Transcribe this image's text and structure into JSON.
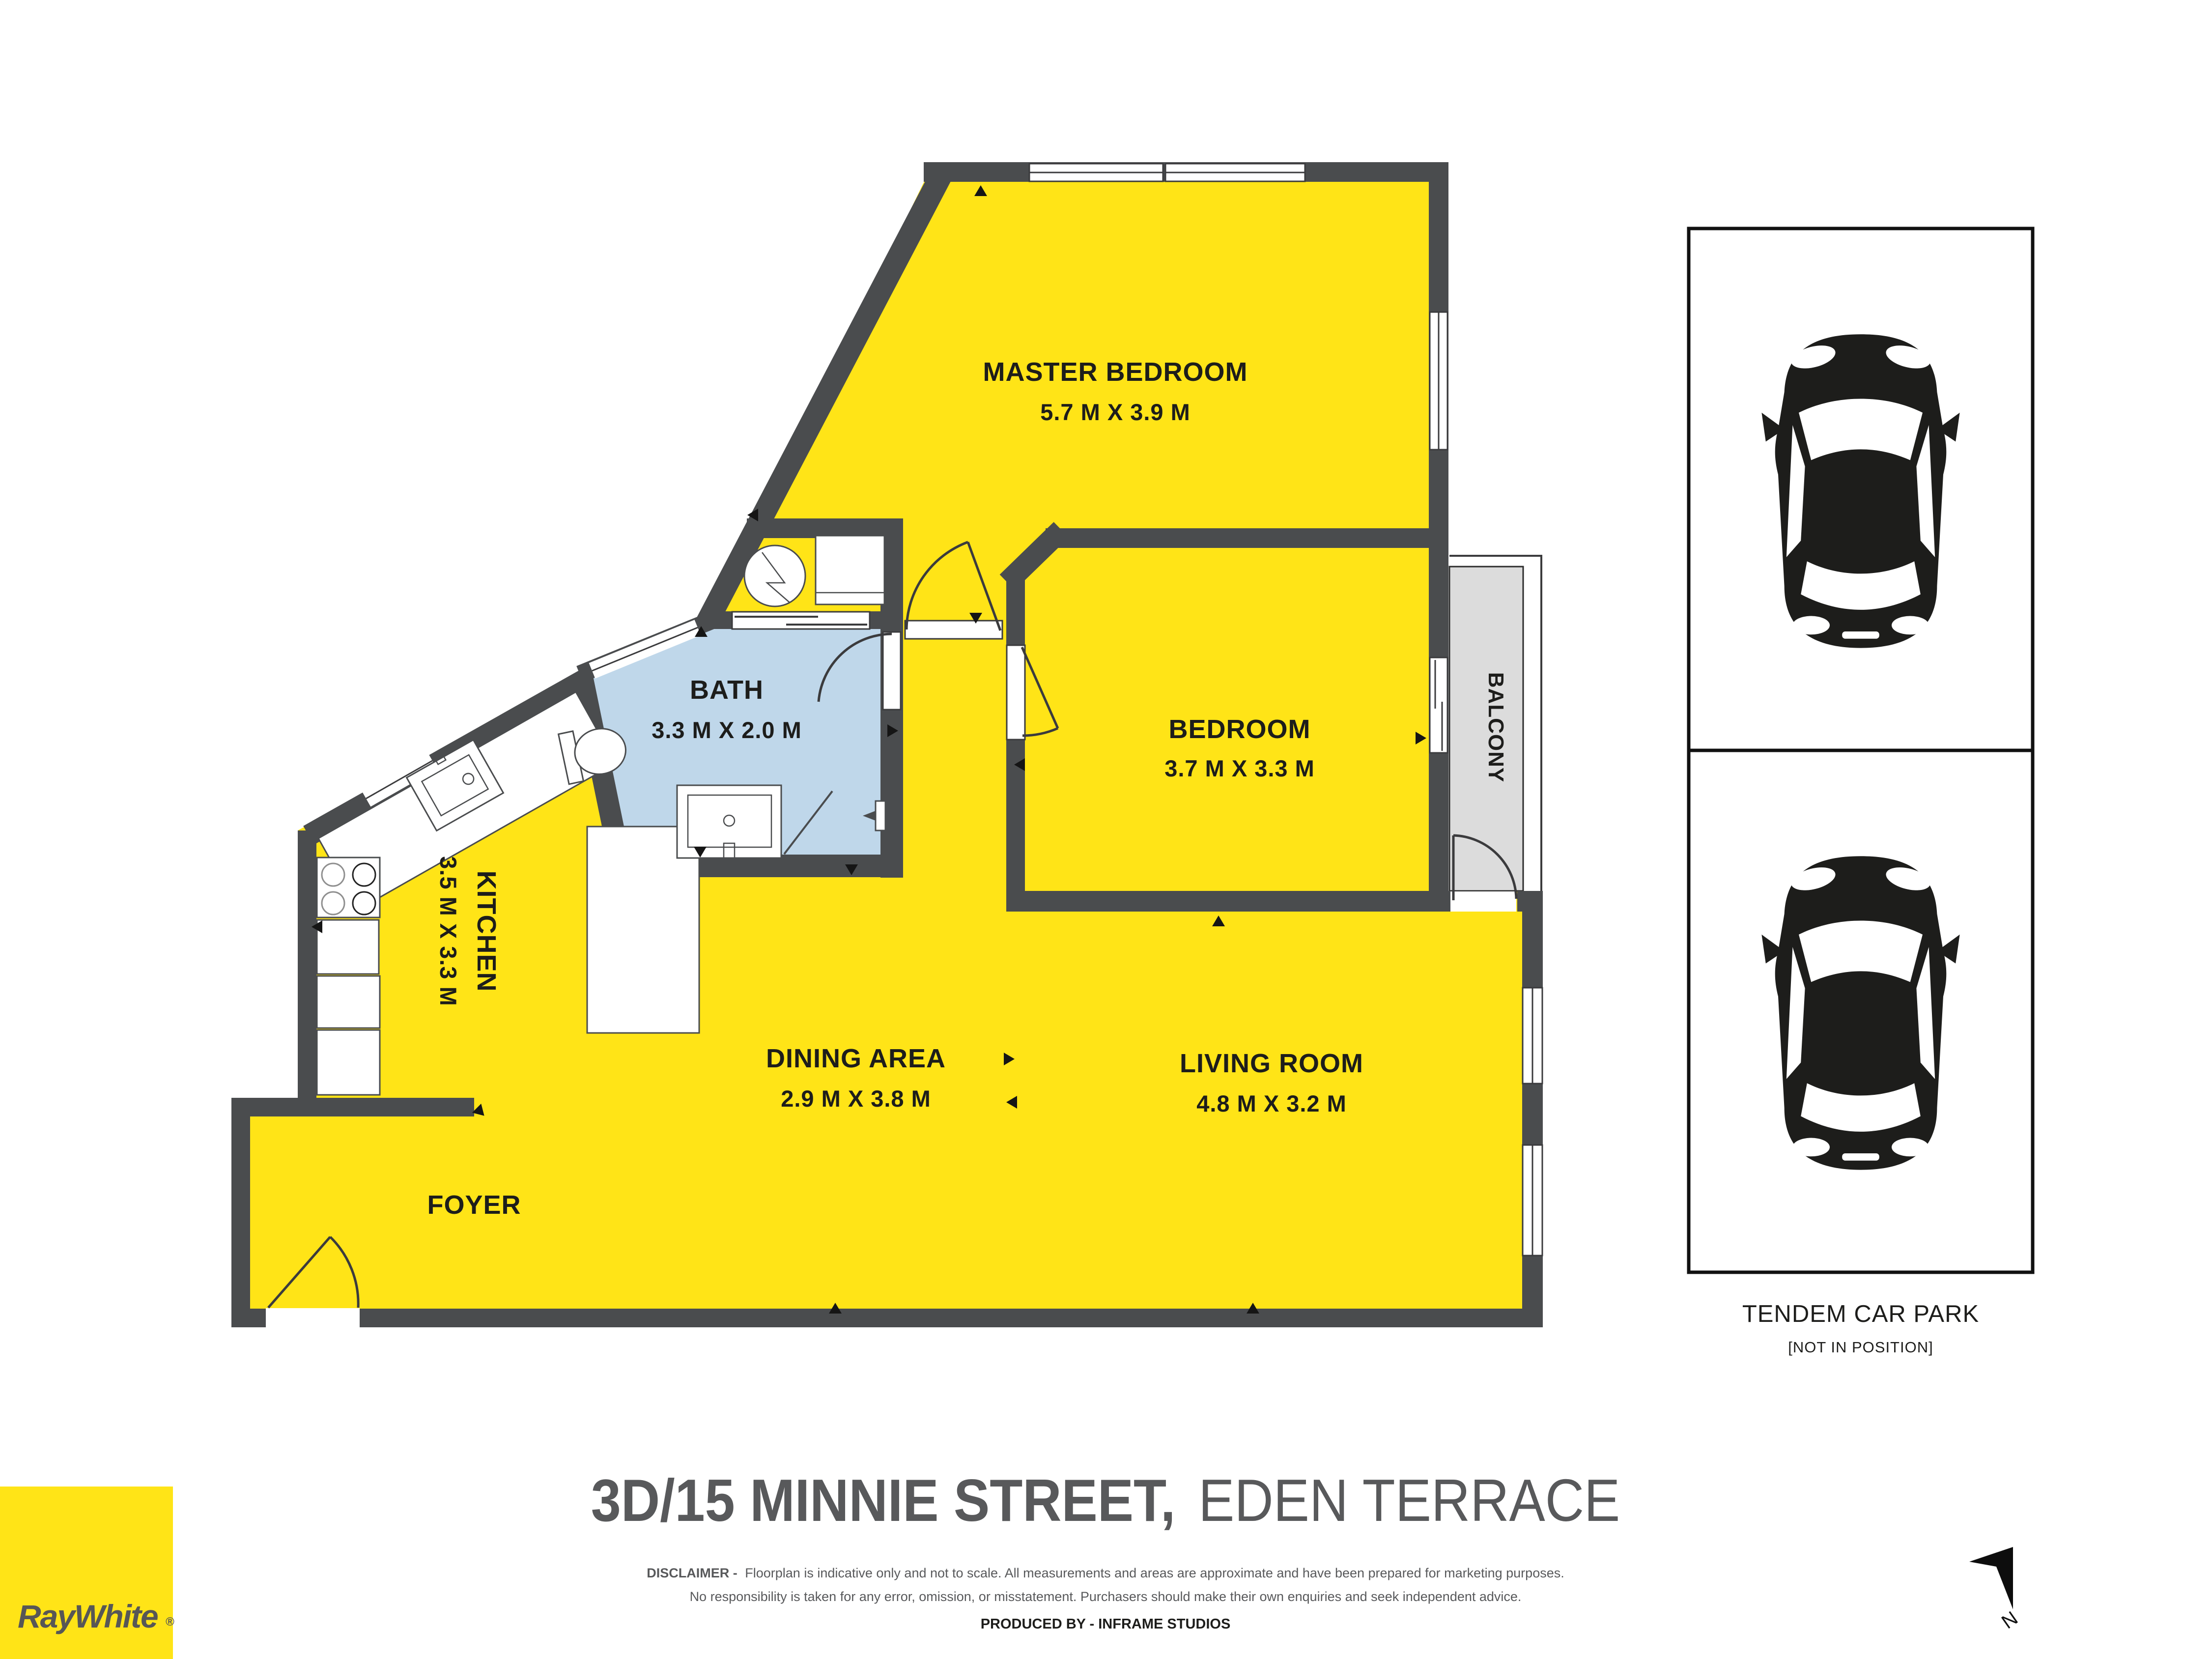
{
  "rooms": {
    "master": {
      "name": "MASTER BEDROOM",
      "dims": "5.7 M X 3.9 M"
    },
    "bedroom": {
      "name": "BEDROOM",
      "dims": "3.7 M X 3.3 M"
    },
    "bath": {
      "name": "BATH",
      "dims": "3.3 M X 2.0 M"
    },
    "kitchen": {
      "name": "KITCHEN",
      "dims": "3.5 M X 3.3 M"
    },
    "dining": {
      "name": "DINING AREA",
      "dims": "2.9 M X 3.8 M"
    },
    "living": {
      "name": "LIVING ROOM",
      "dims": "4.8 M X 3.2 M"
    },
    "foyer": {
      "name": "FOYER"
    },
    "balcony": {
      "name": "BALCONY"
    }
  },
  "carpark": {
    "title": "TENDEM CAR PARK",
    "subtitle": "[NOT IN POSITION]"
  },
  "compass": {
    "label": "N"
  },
  "footer": {
    "address_bold": "3D/15 MINNIE STREET,",
    "address_light": "EDEN TERRACE",
    "disclaimer_bold": "DISCLAIMER -",
    "disclaimer_rest": "Floorplan is indicative only and not to scale. All measurements and areas are approximate and have been prepared for marketing purposes.",
    "disclaimer_line2": "No responsibility is taken for any error, omission, or misstatement. Purchasers should make their own enquiries and seek independent advice.",
    "produced_by": "PRODUCED BY - INFRAME STUDIOS",
    "brand": "RayWhite",
    "brand_reg": "®"
  },
  "colors": {
    "floor_yellow": "#FFE417",
    "wall_gray": "#4A4C4E",
    "bath_blue": "#BFD7EA",
    "balcony_gray": "#DCDCDC",
    "title_gray": "#58595B"
  }
}
